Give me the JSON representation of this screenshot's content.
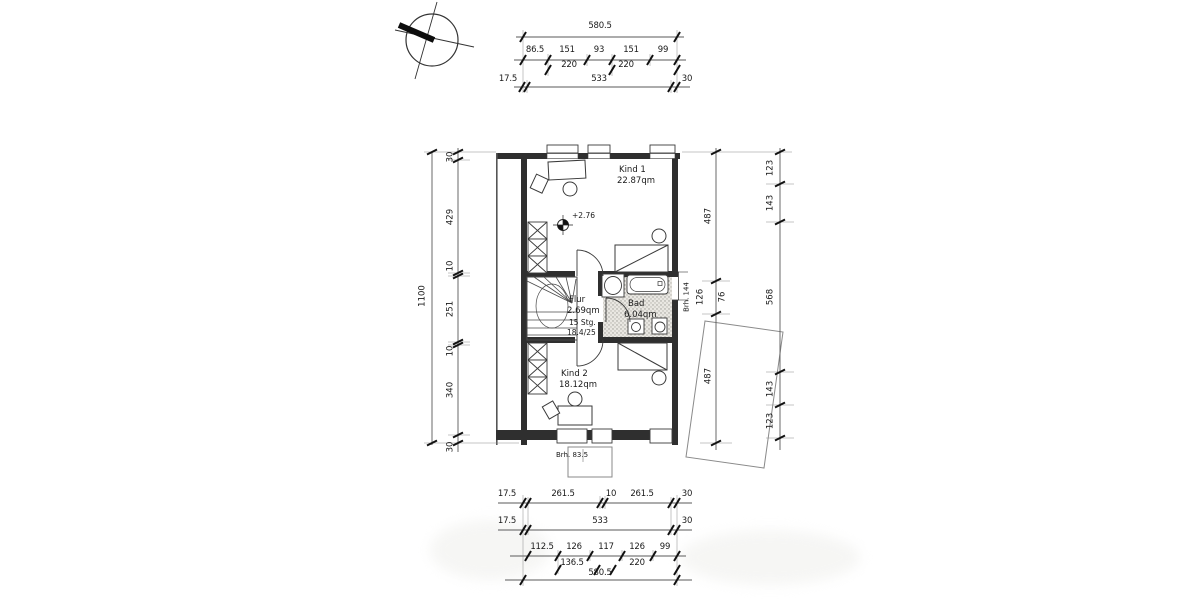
{
  "plan": {
    "room1_name": "Kind 1",
    "room1_area": "22.87qm",
    "room2_name": "Kind 2",
    "room2_area": "18.12qm",
    "flur_name": "Flur",
    "flur_area": "2.69qm",
    "stair_count": "15 Stg.",
    "stair_ratio": "18.4/25",
    "bad_name": "Bad",
    "bad_area": "6.04qm",
    "level_marker": "+2.76",
    "parapet_right": "Brh. 144",
    "parapet_bottom": "Brh. 83.5"
  },
  "dims_top": {
    "total": "580.5",
    "seg": [
      "86.5",
      "151",
      "93",
      "151",
      "99"
    ],
    "sub": [
      "220",
      "220"
    ],
    "base": [
      "17.5",
      "533",
      "30"
    ]
  },
  "dims_left": {
    "total": "1100",
    "seg": [
      "30",
      "429",
      "10",
      "251",
      "10",
      "340",
      "30"
    ]
  },
  "dims_right": {
    "inner": [
      "487",
      "126",
      "76",
      "487"
    ],
    "outer": [
      "123",
      "143",
      "568",
      "143",
      "123"
    ]
  },
  "dims_bottom": {
    "r1": [
      "17.5",
      "261.5",
      "10",
      "261.5",
      "30"
    ],
    "r2": [
      "17.5",
      "533",
      "30"
    ],
    "r3": [
      "112.5",
      "126",
      "117",
      "126",
      "99"
    ],
    "r4": [
      "136.5",
      "220"
    ],
    "total": "580.5"
  },
  "colors": {
    "wall": "#2f2f2f",
    "line": "#555555",
    "paper": "#ffffff"
  }
}
